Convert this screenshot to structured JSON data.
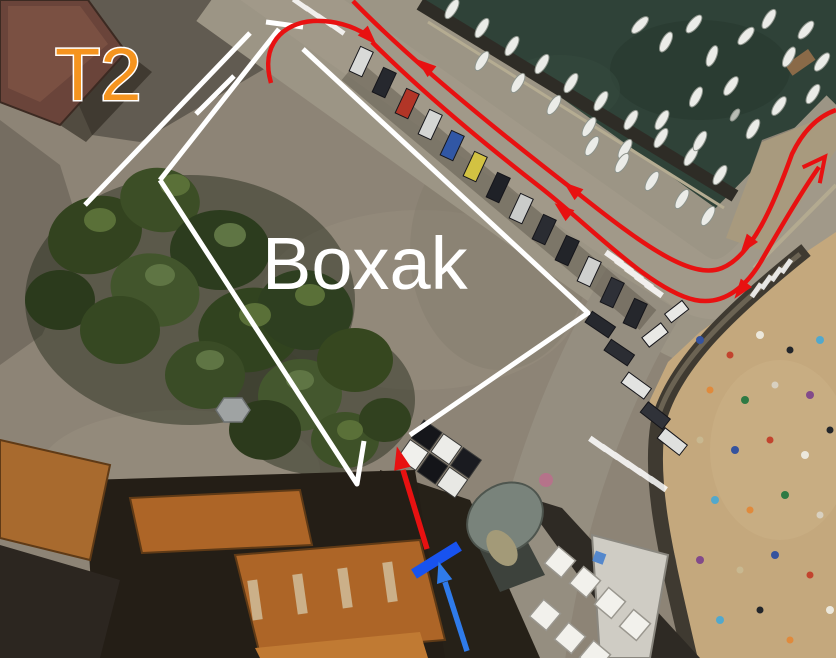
{
  "map_labels": {
    "territory": "T2",
    "area": "Boxak"
  },
  "annotation_colors": {
    "territory_label": "#f5941f",
    "area_label": "#ffffff",
    "route": "#e81111",
    "boundary": "#ffffff",
    "stop_bar": "#1853ef",
    "approach_arrow": "#2f7bea"
  }
}
